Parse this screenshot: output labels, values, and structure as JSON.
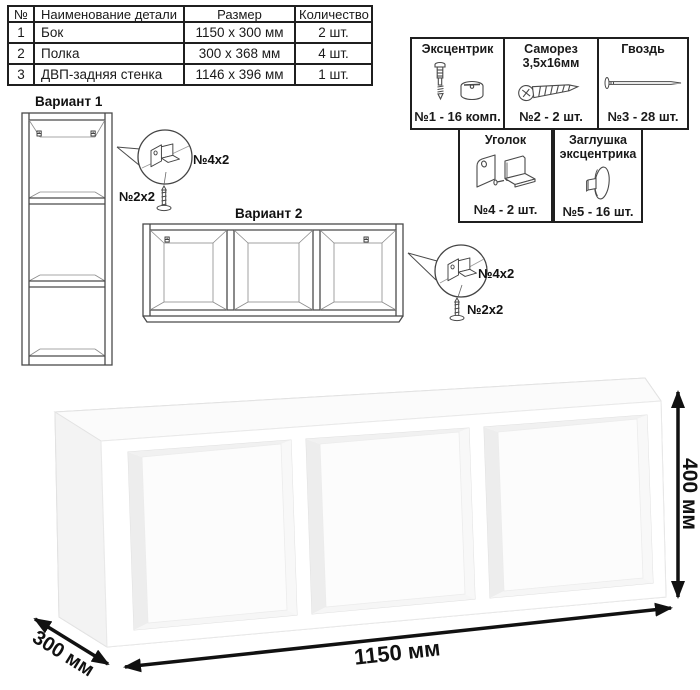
{
  "parts_table": {
    "headers": [
      "№",
      "Наименование детали",
      "Размер",
      "Количество"
    ],
    "rows": [
      {
        "num": "1",
        "name": "Бок",
        "size": "1150 х 300 мм",
        "qty": "2 шт."
      },
      {
        "num": "2",
        "name": "Полка",
        "size": "300 х 368 мм",
        "qty": "4 шт."
      },
      {
        "num": "3",
        "name": "ДВП-задняя стенка",
        "size": "1146 х 396 мм",
        "qty": "1 шт."
      }
    ]
  },
  "hardware": {
    "items": [
      {
        "title": "Эксцентрик",
        "qty": "№1 - 16 комп.",
        "icon": "eccentric-cam-icon"
      },
      {
        "title": "Саморез 3,5х16мм",
        "qty": "№2 - 2 шт.",
        "icon": "screw-icon"
      },
      {
        "title": "Гвоздь",
        "qty": "№3 - 28 шт.",
        "icon": "nail-icon"
      },
      {
        "title": "Уголок",
        "qty": "№4 - 2 шт.",
        "icon": "corner-bracket-icon"
      },
      {
        "title": "Заглушка эксцентрика",
        "qty": "№5 - 16 шт.",
        "icon": "eccentric-cap-icon"
      }
    ]
  },
  "variants": {
    "variant1_title": "Вариант 1",
    "variant2_title": "Вариант 2",
    "callout1": {
      "bracket_label": "№4х2",
      "screw_label": "№2х2"
    },
    "callout2": {
      "bracket_label": "№4х2",
      "screw_label": "№2х2"
    }
  },
  "dimensions": {
    "width": "1150 мм",
    "height": "400 мм",
    "depth": "300 мм"
  }
}
